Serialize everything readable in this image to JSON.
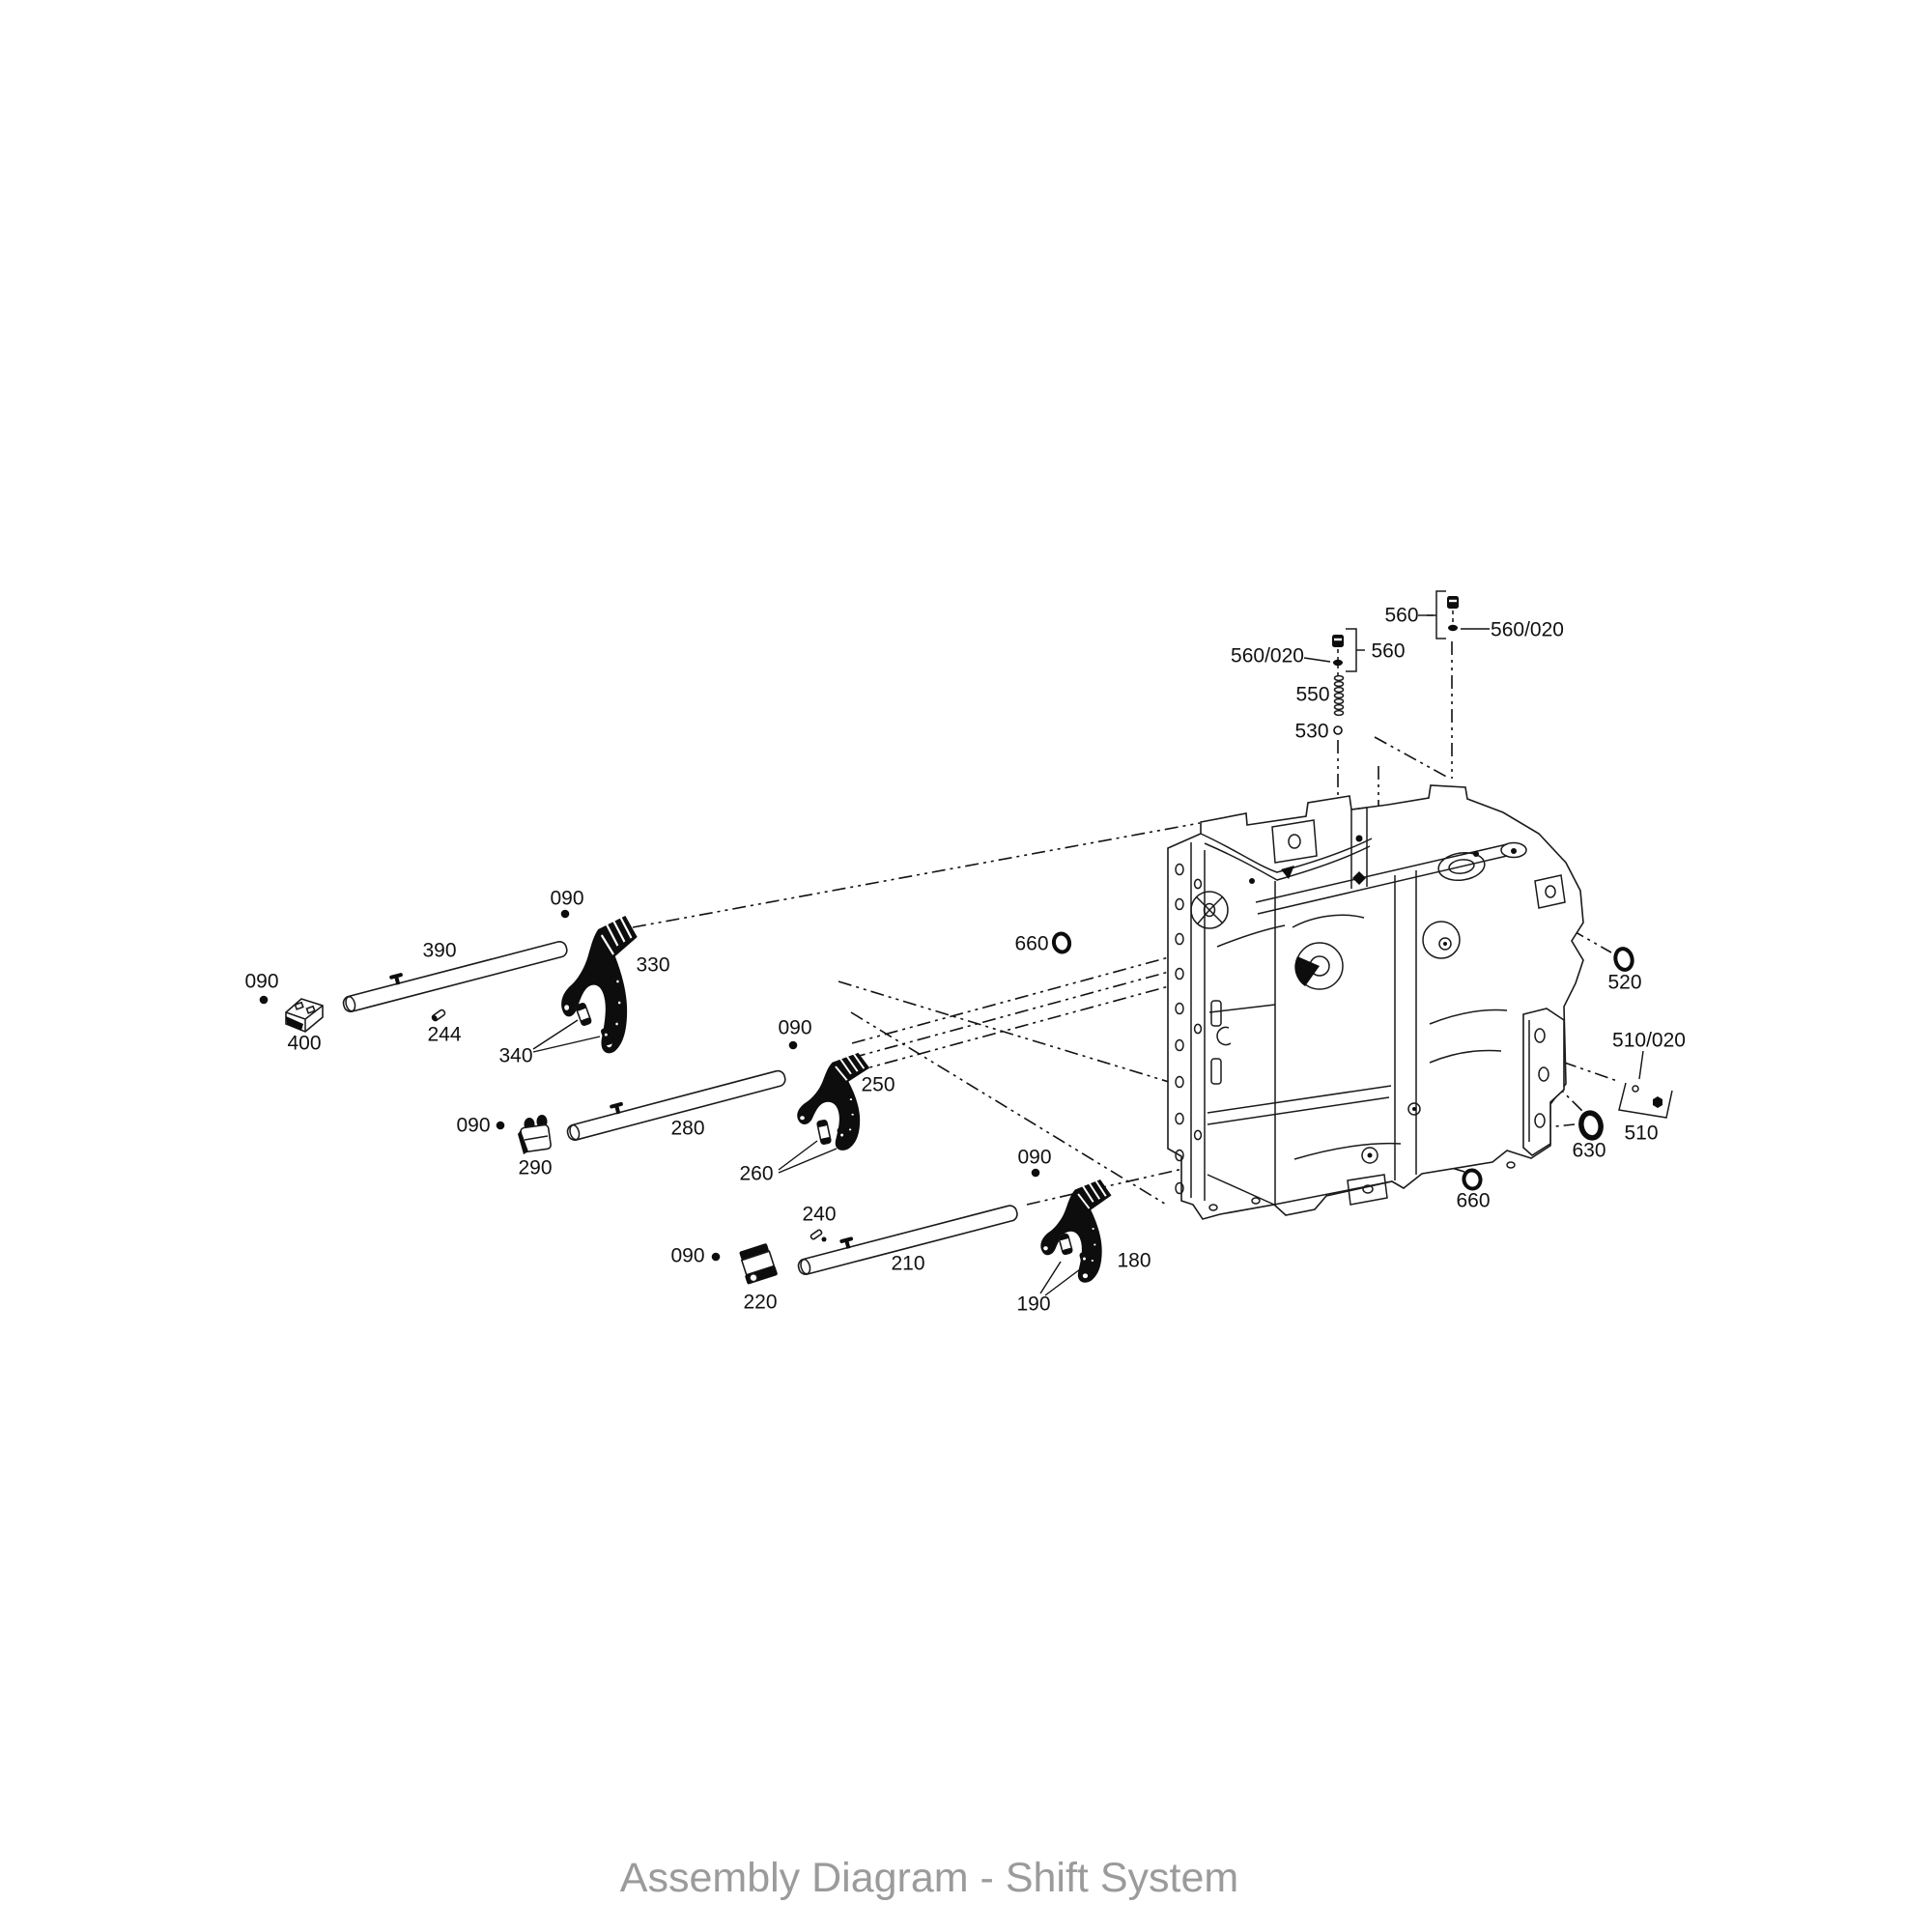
{
  "page": {
    "background": "#ffffff",
    "line_color": "#1a1a1a",
    "caption_color": "#9b9b9b"
  },
  "diagram": {
    "caption": "Assembly Diagram - Shift System",
    "labels": [
      {
        "text": "090"
      },
      {
        "text": "390"
      },
      {
        "text": "330"
      },
      {
        "text": "090"
      },
      {
        "text": "400"
      },
      {
        "text": "244"
      },
      {
        "text": "340"
      },
      {
        "text": "090"
      },
      {
        "text": "290"
      },
      {
        "text": "280"
      },
      {
        "text": "090"
      },
      {
        "text": "250"
      },
      {
        "text": "260"
      },
      {
        "text": "240"
      },
      {
        "text": "090"
      },
      {
        "text": "220"
      },
      {
        "text": "210"
      },
      {
        "text": "090"
      },
      {
        "text": "190"
      },
      {
        "text": "180"
      },
      {
        "text": "660"
      },
      {
        "text": "660"
      },
      {
        "text": "520"
      },
      {
        "text": "510/020"
      },
      {
        "text": "510"
      },
      {
        "text": "630"
      },
      {
        "text": "560/020"
      },
      {
        "text": "560"
      },
      {
        "text": "550"
      },
      {
        "text": "530"
      },
      {
        "text": "560"
      },
      {
        "text": "560/020"
      }
    ]
  }
}
